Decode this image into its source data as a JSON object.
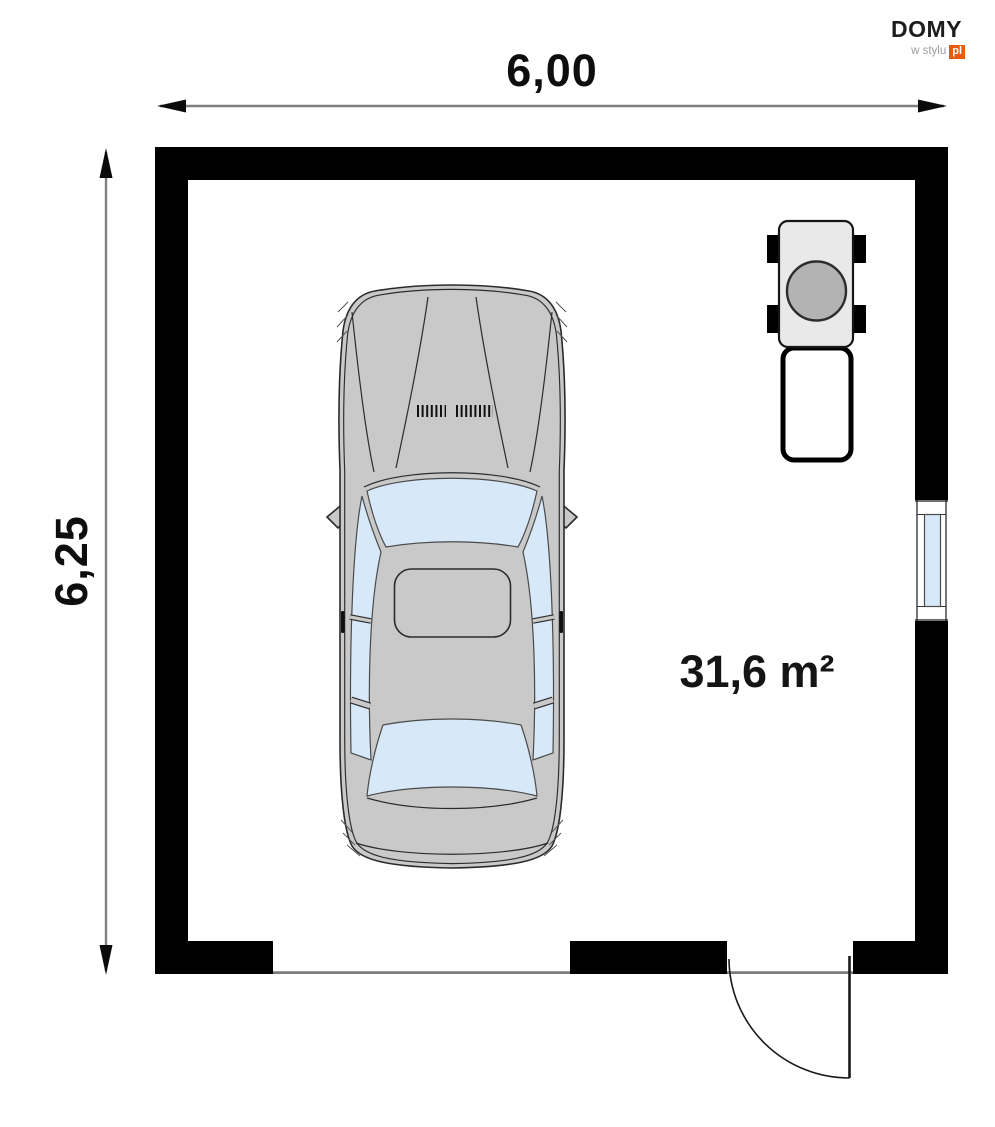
{
  "brand": {
    "name": "DOMY",
    "tagline": "w stylu",
    "suffix": "pl"
  },
  "dimensions": {
    "width_label": "6,00",
    "height_label": "6,25"
  },
  "room": {
    "area_label": "31,6 m²"
  },
  "colors": {
    "wall": "#000000",
    "dimension_line": "#808080",
    "glass": "#d7e9f8",
    "car_body": "#c9c9c9",
    "boiler_body": "#e9e9e9",
    "boiler_burner": "#b3b3b3",
    "logo_orange": "#e95a0c",
    "logo_gray": "#9d9d9c"
  }
}
